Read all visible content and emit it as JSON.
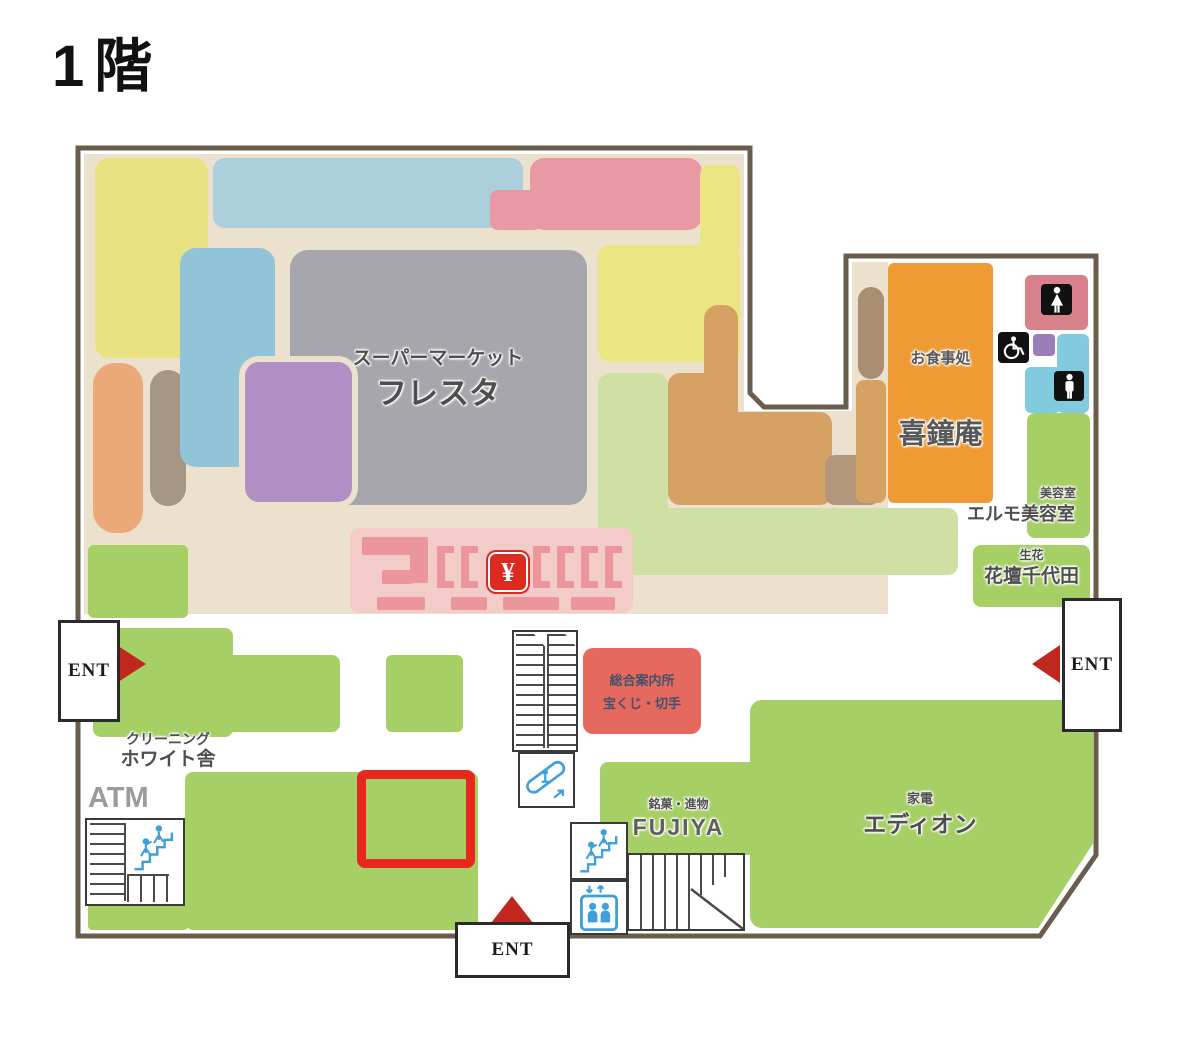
{
  "floor": {
    "title": "1階"
  },
  "stores": {
    "supermarket": {
      "category": "スーパーマーケット",
      "name": "フレスタ"
    },
    "restaurant": {
      "category": "お食事処",
      "name": "喜鐘庵"
    },
    "beauty_salon": {
      "category": "美容室",
      "name": "エルモ美容室"
    },
    "florist": {
      "category": "生花",
      "name": "花壇千代田"
    },
    "cleaning": {
      "category": "クリーニング",
      "name": "ホワイト舎"
    },
    "atm": {
      "name": "ATM"
    },
    "confectionery": {
      "category": "銘菓・進物",
      "name": "FUJIYA"
    },
    "electronics": {
      "category": "家電",
      "name": "エディオン"
    }
  },
  "information": {
    "line1": "総合案内所",
    "line2": "宝くじ・切手"
  },
  "entrances": {
    "left": "ENT",
    "right": "ENT",
    "bottom": "ENT"
  },
  "symbols": {
    "yen": "¥"
  },
  "legend_colors": {
    "highlight": "#e8281e",
    "wall": "#6b5d4b",
    "floor_background": "#ece1cd",
    "shop_green": "#a6cf66",
    "pale_green": "#d0e0a5",
    "restaurant_orange": "#ee9b35",
    "supermarket_gray": "#a6a6ac",
    "register_pink": "#f3cbc8",
    "info_red": "#e6695f",
    "icon_blue": "#3f9fd8"
  }
}
